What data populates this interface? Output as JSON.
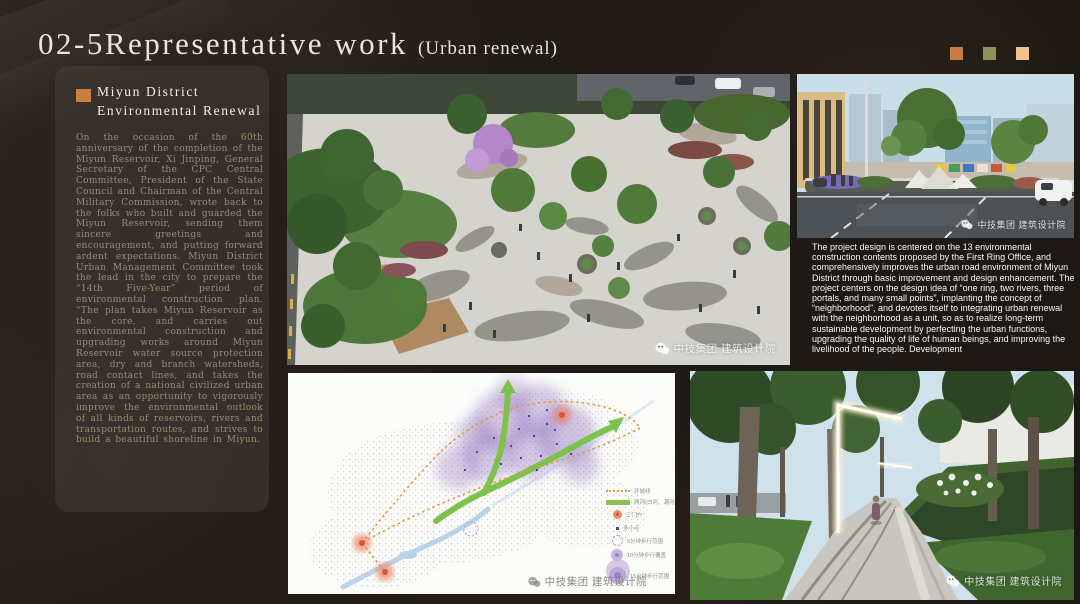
{
  "slide": {
    "title": "02-5Representative work",
    "subtitle": "(Urban renewal)",
    "decor_squares": [
      "#c87c42",
      "#8b9456",
      "#f2c28d"
    ],
    "background_color": "#221c17"
  },
  "sidebar": {
    "bullet_color": "#c87f44",
    "heading_line1": "Miyun District",
    "heading_line2": "Environmental Renewal",
    "body": "On the occasion of the 60th anniversary of the completion of the Miyun Reservoir, Xi Jinping, General Secretary of the CPC Central Committee, President of the State Council and Chairman of the Central Military Commission, wrote back to the folks who built and guarded the Miyun Reservoir, sending them sincere greetings and encouragement, and putting forward ardent expectations. Miyun District Urban Management Committee took the lead in the city to prepare the “14th Five-Year” period of environmental construction plan. “The plan takes Miyun Reservoir as the core, and carries out environmental construction and upgrading works around Miyun Reservoir water source protection area, dry and branch watersheds, road contact lines, and takes the creation of a national civilized urban area as an opportunity to vigorously improve the environmental outlook of all kinds of reservoirs, rivers and transportation routes, and strives to build a beautiful shoreline in Miyun."
  },
  "right_text": {
    "body": "The project design is centered on the 13 environmental construction contents proposed by the First Ring Office, and comprehensively improves the urban road environment of Miyun District through basic improvement and design enhancement. The project centers on the design idea of “one ring, two rivers, three portals, and many small points”, implanting the concept of “neighborhood”, and devotes itself to integrating urban renewal with the neighborhood as a unit, so as to realize long-term sustainable development by perfecting the urban functions, upgrading the quality of life of human beings, and improving the livelihood of the people. Development"
  },
  "watermark": {
    "text": "中技集团 建筑设计院"
  },
  "map": {
    "legend": [
      {
        "symbol": "ring-dotted-line",
        "label": "环城线",
        "color": "#e39a3a"
      },
      {
        "symbol": "rivers-bar",
        "label": "两河(白河、潮河)",
        "color": "#8cc152"
      },
      {
        "symbol": "portal-circle",
        "label": "三门户",
        "color": "#eb8a6e"
      },
      {
        "symbol": "small-point",
        "label": "多小点",
        "color": "#5a3f9f"
      },
      {
        "symbol": "dashed-circle",
        "label": "5分钟步行范围",
        "color": "#b09cd2"
      },
      {
        "symbol": "filled-circle",
        "label": "10分钟步行覆盖",
        "color": "#c6b4e0"
      },
      {
        "symbol": "filled-circle-large",
        "label": "15分钟步行范围",
        "color": "#baa7d8"
      }
    ]
  }
}
